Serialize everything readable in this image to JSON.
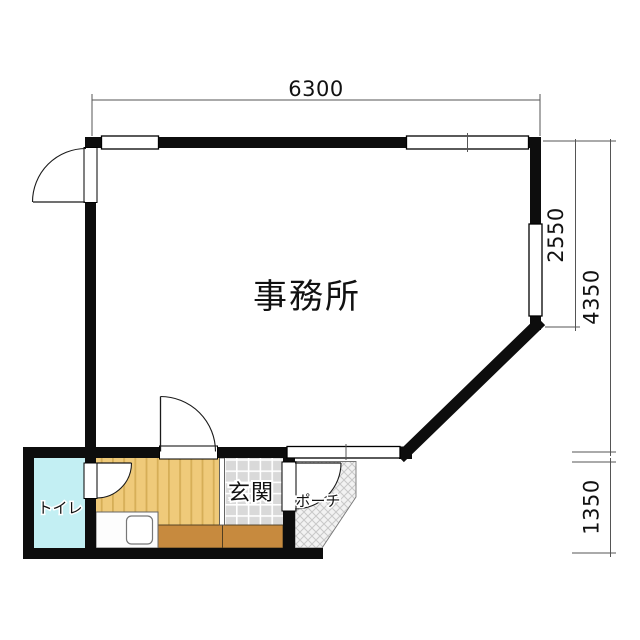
{
  "floorplan": {
    "rooms": {
      "office": {
        "label": "事務所"
      },
      "toilet": {
        "label": "トイレ"
      },
      "entrance": {
        "label": "玄関"
      },
      "porch": {
        "label": "ポーチ"
      }
    },
    "dimensions": {
      "top_width": "6300",
      "right_upper": "2550",
      "right_total": "4350",
      "bottom_right": "1350"
    },
    "colors": {
      "wall": "#0d0d0d",
      "toilet_floor": "#c3eff3",
      "wood_floor": "#efca7a",
      "wood_stripe": "#d6ae57",
      "tile_floor": "#d9d9d9",
      "step_brown": "#c78a3e",
      "counter": "#fdfdfd",
      "porch_hatch_line": "#c8c8c8",
      "dimension_line": "#555555"
    }
  }
}
